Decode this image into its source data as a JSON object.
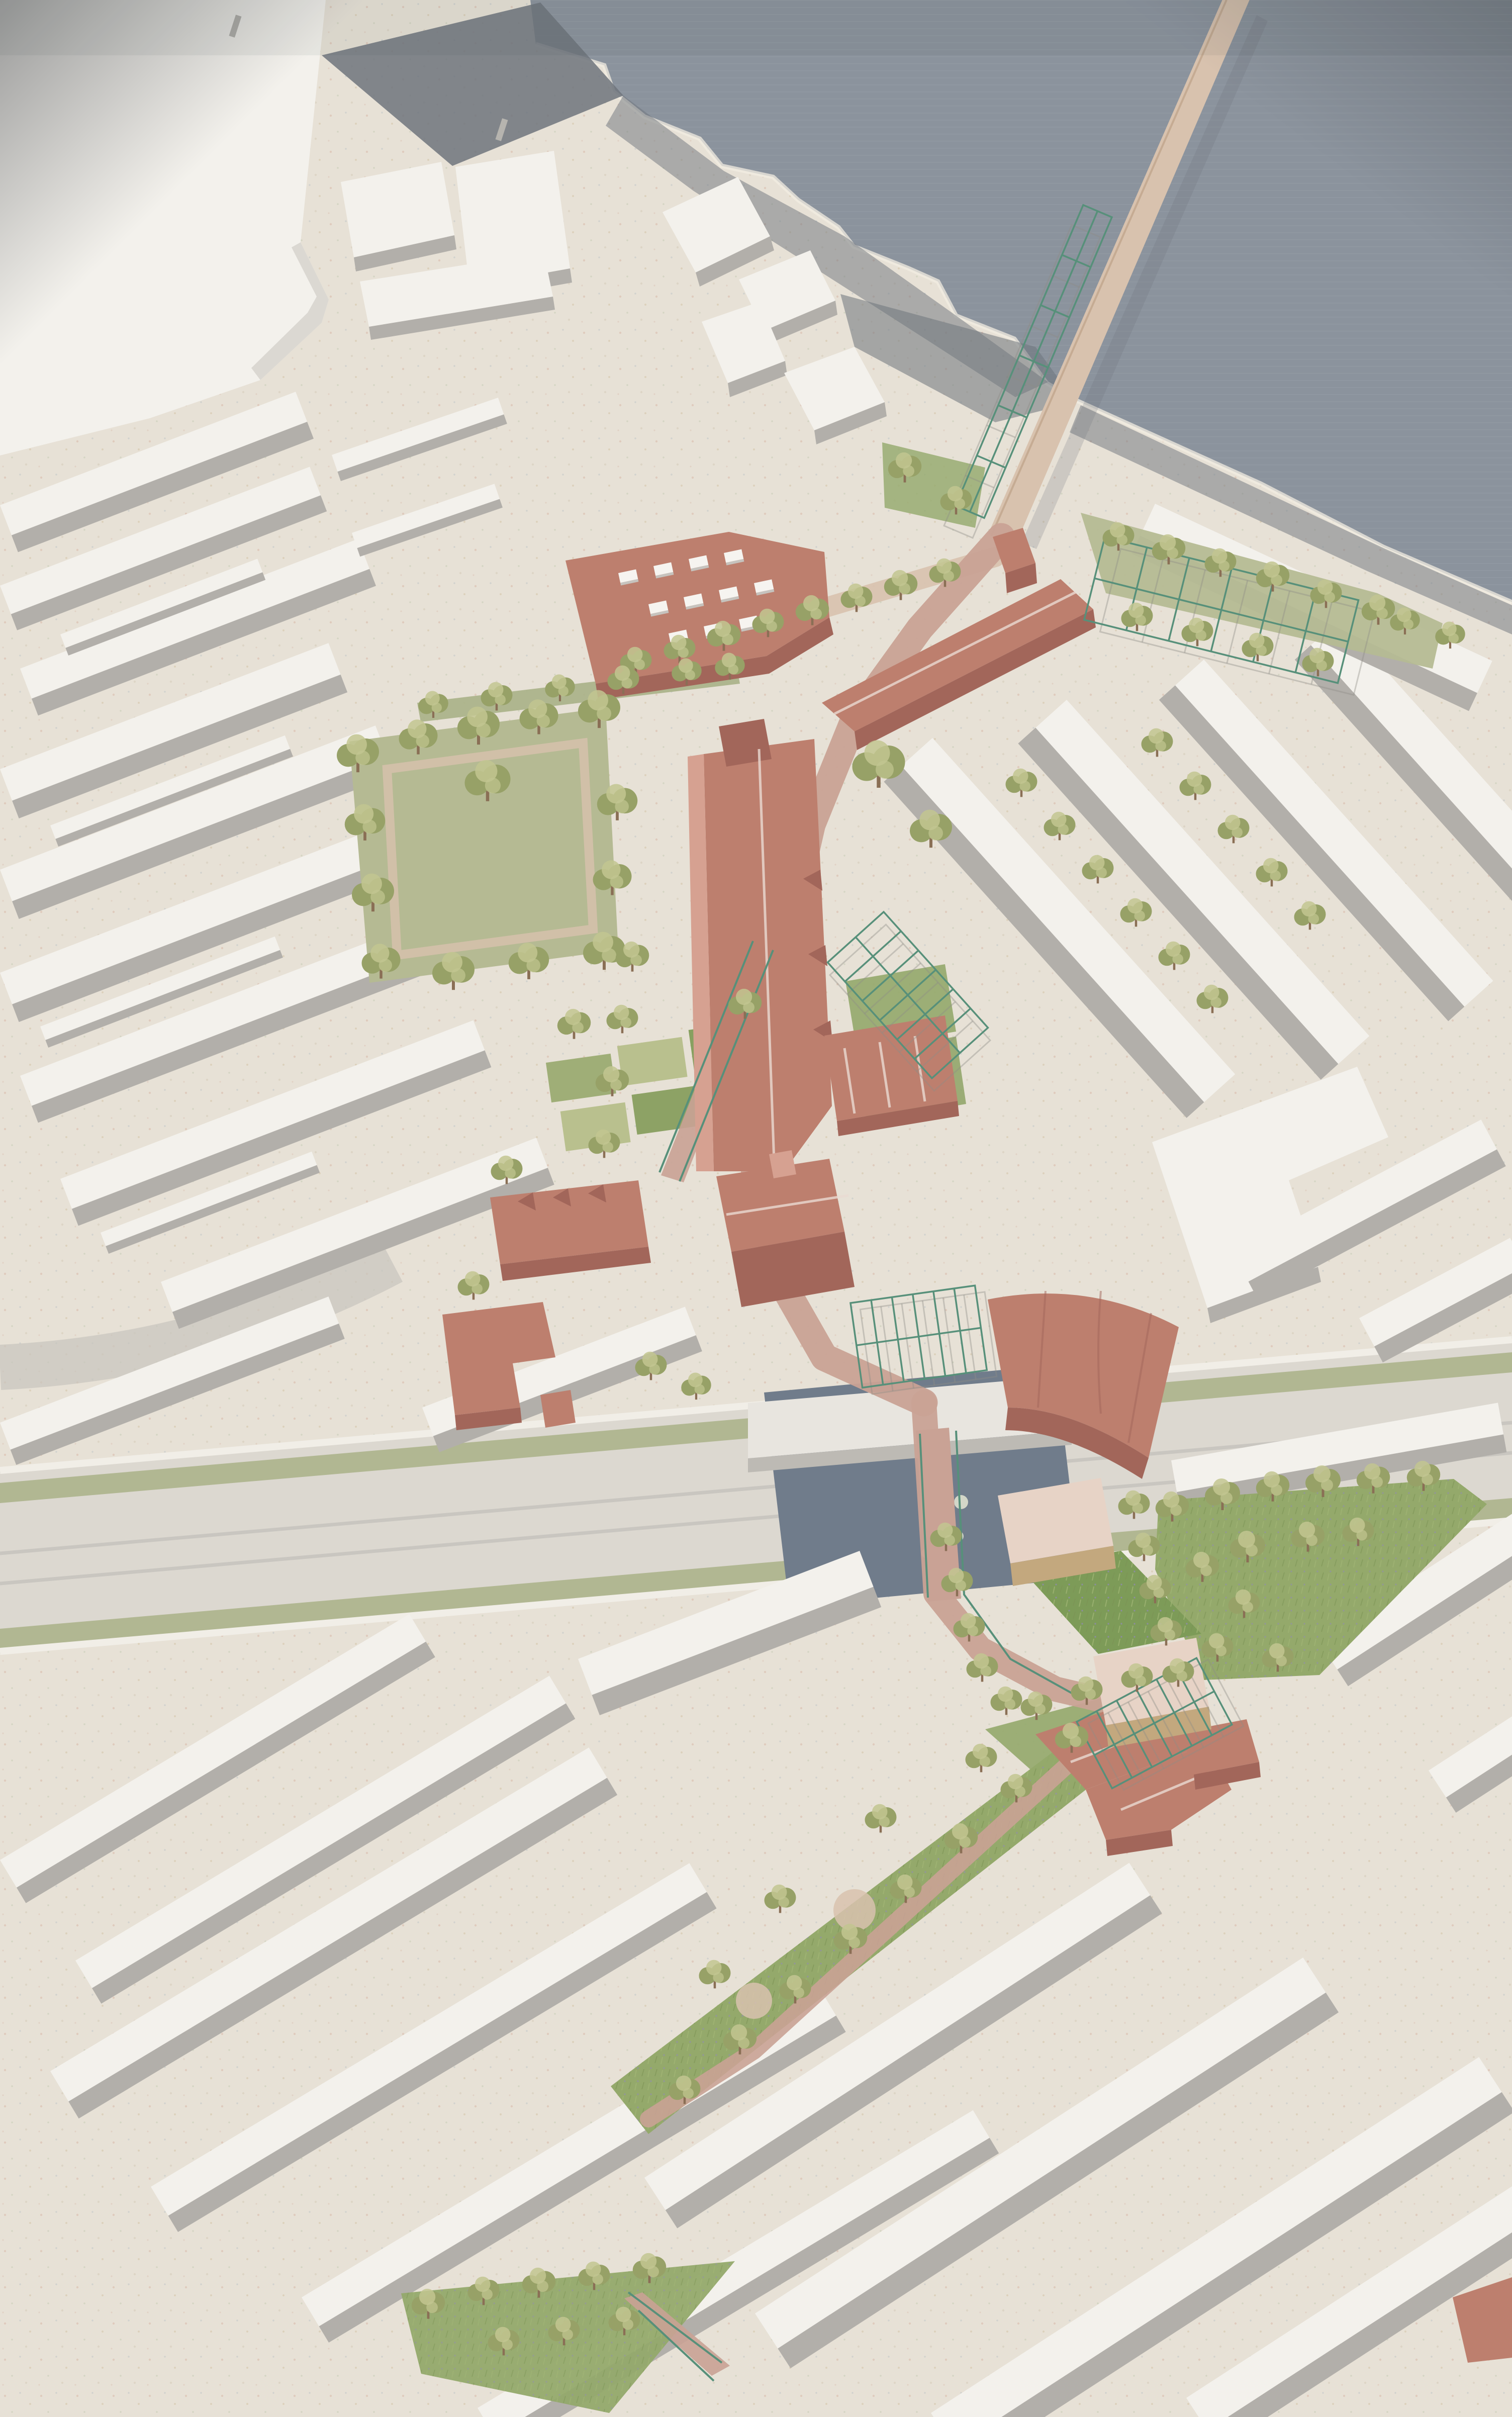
{
  "meta": {
    "title": "Aerial axonometric masterplan rendering of a riverside neighbourhood",
    "view": "aerial axonometric",
    "media": "photographed architectural visualisation, no text or UI elements visible"
  },
  "palette": {
    "ground": "#e7e1d6",
    "water_river": "#8b939d",
    "water_canal": "#707c8b",
    "bldg_roof": "#f3f1ec",
    "bldg_face": "#dbd8d2",
    "bldg_shadow": "#b2afaa",
    "street_shadow": "#c7c4be",
    "dark_wharf": "#6e747c",
    "wall_white": "#f1eee7",
    "terracotta_roof": "#bd7f6e",
    "terracotta_light": "#d6a191",
    "terracotta_dark": "#a2665a",
    "timber": "#c3a87e",
    "pavilion_roof": "#e7d3c6",
    "lawn": "#b5ba93",
    "meadow": "#94a96b",
    "verge_olive": "#a9b187",
    "tree_olive": "#97a167",
    "tree_light": "#c2c691",
    "trunk": "#8a6f55",
    "trellis_green": "#57907a",
    "path_brick": "#c9a295",
    "path_tan": "#d8c2ae",
    "rail_deck": "#dcd8d0",
    "vignette": "#3f4246"
  },
  "features": {
    "river": "grey-blue river across the top right corner",
    "jetty": "long straight timber jetty with green steel pergola frames reaching into the river",
    "riverside_garden": "lawn with green pergola grid and tree rows beside the jetty landing",
    "proposed_buildings": "terracotta-roofed proposal buildings along a central spine from the river to the railway",
    "context_buildings": "white massing model of existing terraced streets on all sides",
    "square_park": "tree-ringed green square west of the spine",
    "allotments": "small rectangular garden plots south of the square",
    "rail_corridor": "pale railway corridor with olive verges crossing the whole plan",
    "canal_basin": "dark canal basin with lily pads bridged by the railway and a brick path",
    "timber_pavilions": "two timber pavilions with a planted courtyard beside the canal path",
    "wildflower_triangle": "triangular wildflower lawn with perimeter trees east of the canal",
    "linear_garden": "long wildflower garden with central path running south-west",
    "pocket_park": "triangular pocket park with ramp at the bottom edge",
    "tree_count_approx": 100,
    "trellis_count": 5
  }
}
